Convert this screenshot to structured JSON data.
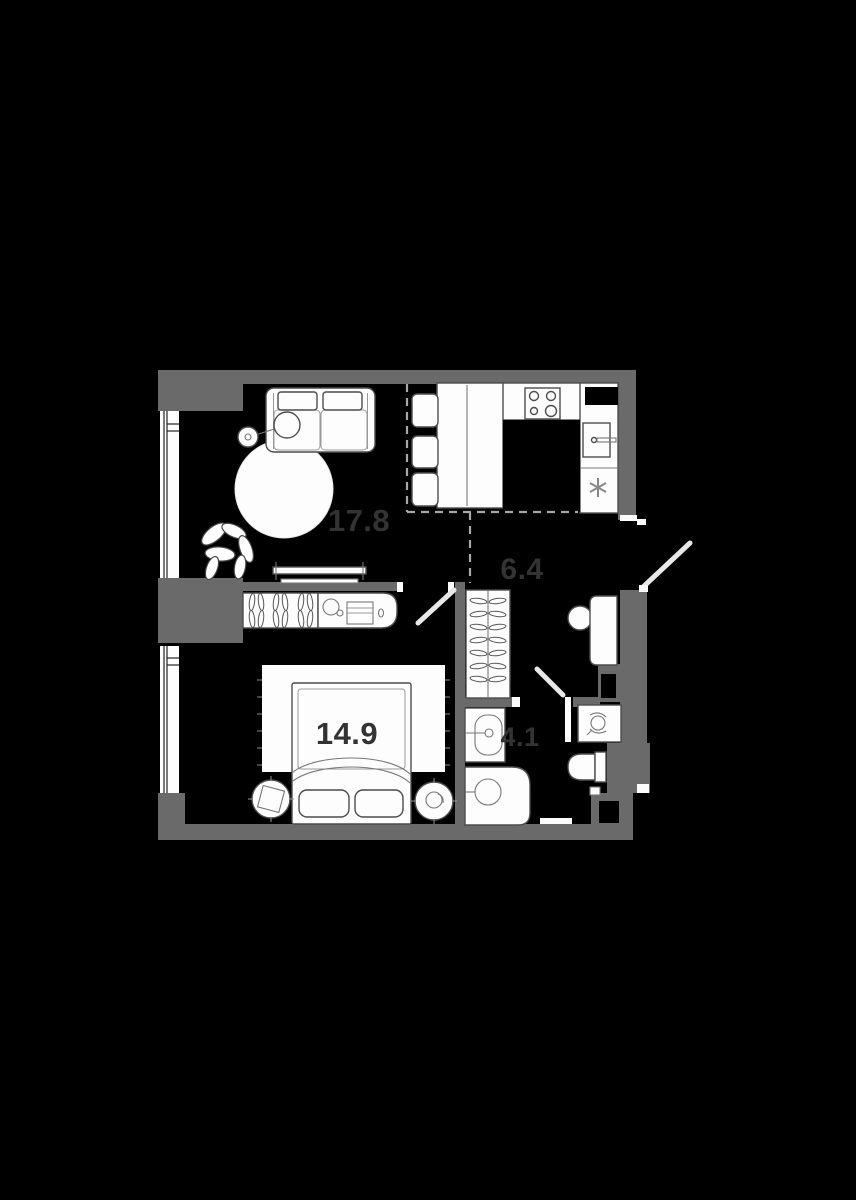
{
  "meta": {
    "type": "apartment-floor-plan",
    "style": "dark-real-estate-plan"
  },
  "canvas": {
    "width": 856,
    "height": 1200,
    "background": "#000000"
  },
  "palette": {
    "wall": "#6a6a6a",
    "furniture_fill": "#fdfdfd",
    "outline": "#4d4d4d",
    "dashed_zone": "#a8a8a8",
    "area_label": "#333333"
  },
  "rooms": {
    "living_room": {
      "area_label": "17.8",
      "furniture_icons": [
        "sofa-icon",
        "floor-lamp-icon",
        "round-rug-icon",
        "plant-icon",
        "tv-console-icon",
        "window-icon"
      ]
    },
    "kitchen_zone": {
      "area_label": "",
      "furniture_icons": [
        "dining-table-icon",
        "chair-icon",
        "stove-icon",
        "kitchen-sink-icon",
        "fridge-asterisk-icon",
        "vent-shaft-icon"
      ]
    },
    "hallway": {
      "area_label": "6.4",
      "furniture_icons": [
        "wardrobe-hangers-icon",
        "desk-icon",
        "chair-icon",
        "entrance-door-icon"
      ]
    },
    "bedroom": {
      "area_label": "14.9",
      "furniture_icons": [
        "double-bed-icon",
        "pillow-icon",
        "nightstand-icon",
        "rug-icon",
        "wardrobe-hangers-icon",
        "vanity-icon",
        "window-icon"
      ]
    },
    "bathroom": {
      "area_label": "4.1",
      "furniture_icons": [
        "bathroom-sink-icon",
        "washing-machine-icon",
        "shower-icon",
        "toilet-icon",
        "door-icon"
      ]
    }
  }
}
